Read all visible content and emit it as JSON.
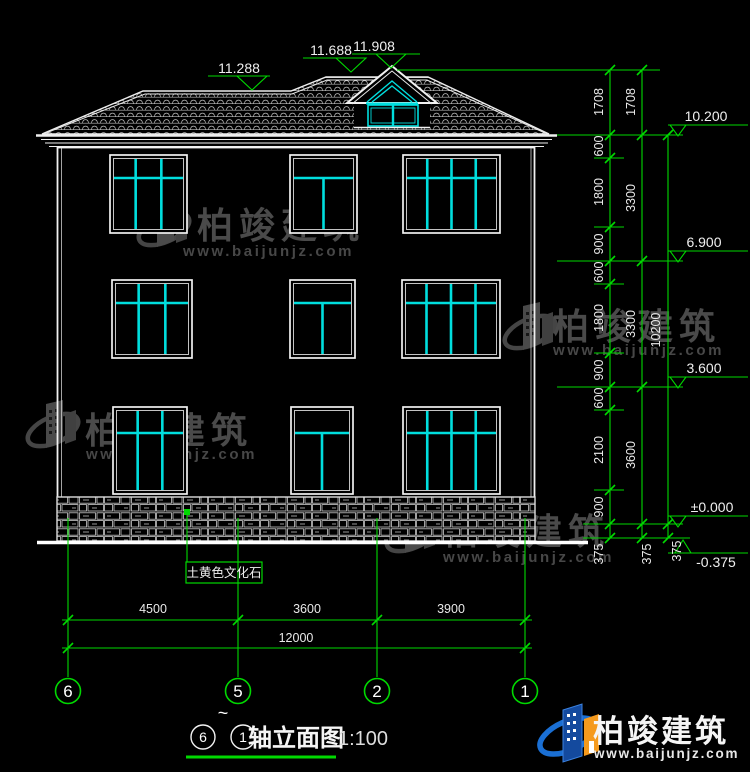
{
  "brand": {
    "name": "柏竣建筑",
    "url": "www.baijunjz.com"
  },
  "top_markers": [
    {
      "value": "11.288"
    },
    {
      "value": "11.688"
    },
    {
      "value": "11.908"
    }
  ],
  "right_markers": [
    {
      "value": "10.200"
    },
    {
      "value": "6.900"
    },
    {
      "value": "3.600"
    },
    {
      "value": "±0.000"
    },
    {
      "value": "-0.375"
    }
  ],
  "dims": {
    "col1": [
      "1708",
      "600",
      "1800",
      "900",
      "600",
      "1800",
      "900",
      "600",
      "2100",
      "900",
      "375"
    ],
    "col2": [
      "1708",
      "3300",
      "3300",
      "3600",
      "375"
    ],
    "col3": [
      "10200",
      "375"
    ],
    "bottom": [
      "4500",
      "3600",
      "3900"
    ],
    "total": "12000"
  },
  "axes": {
    "bubbles": [
      "6",
      "5",
      "2",
      "1"
    ]
  },
  "material_label": "土黄色文化石",
  "title": {
    "from": "6",
    "tilde": "~",
    "to": "1",
    "name": "轴立面图",
    "scale": "1:100"
  },
  "colors": {
    "annotation_green": "#00d900",
    "window_cyan": "#00dede",
    "line_white": "#f1f1f1",
    "logo_blue": "#1a6fd4",
    "logo_orange": "#f59a1d"
  }
}
